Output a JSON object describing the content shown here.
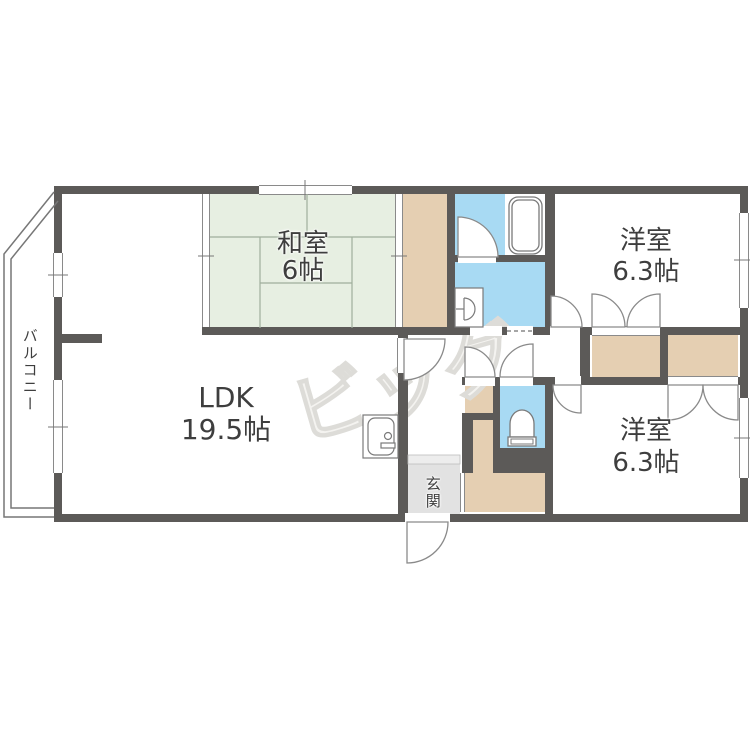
{
  "colors": {
    "wall": "#5c5a58",
    "tatami": "#e7efe2",
    "tatami-line": "#9fae9c",
    "closet": "#e5cfb2",
    "water": "#a8daf3",
    "genkan": "#e2e2e2",
    "outline": "#8a8a8a",
    "watermark": "#dddcd8",
    "label": "#3e3e3e"
  },
  "rooms": {
    "ldk": {
      "label": "LDK",
      "size": "19.5帖"
    },
    "washitsu": {
      "label": "和室",
      "size": "6帖"
    },
    "bedroom1": {
      "label": "洋室",
      "size": "6.3帖"
    },
    "bedroom2": {
      "label": "洋室",
      "size": "6.3帖"
    },
    "entrance": {
      "label": "玄関"
    },
    "balcony": {
      "label": "バルコニー"
    }
  },
  "watermark": {
    "text": "ビッグ"
  },
  "fixtures": {
    "bathtub": "bathtub-icon",
    "toilet": "toilet-icon",
    "washbasin": "washbasin-icon",
    "washer": "washing-machine-icon"
  }
}
